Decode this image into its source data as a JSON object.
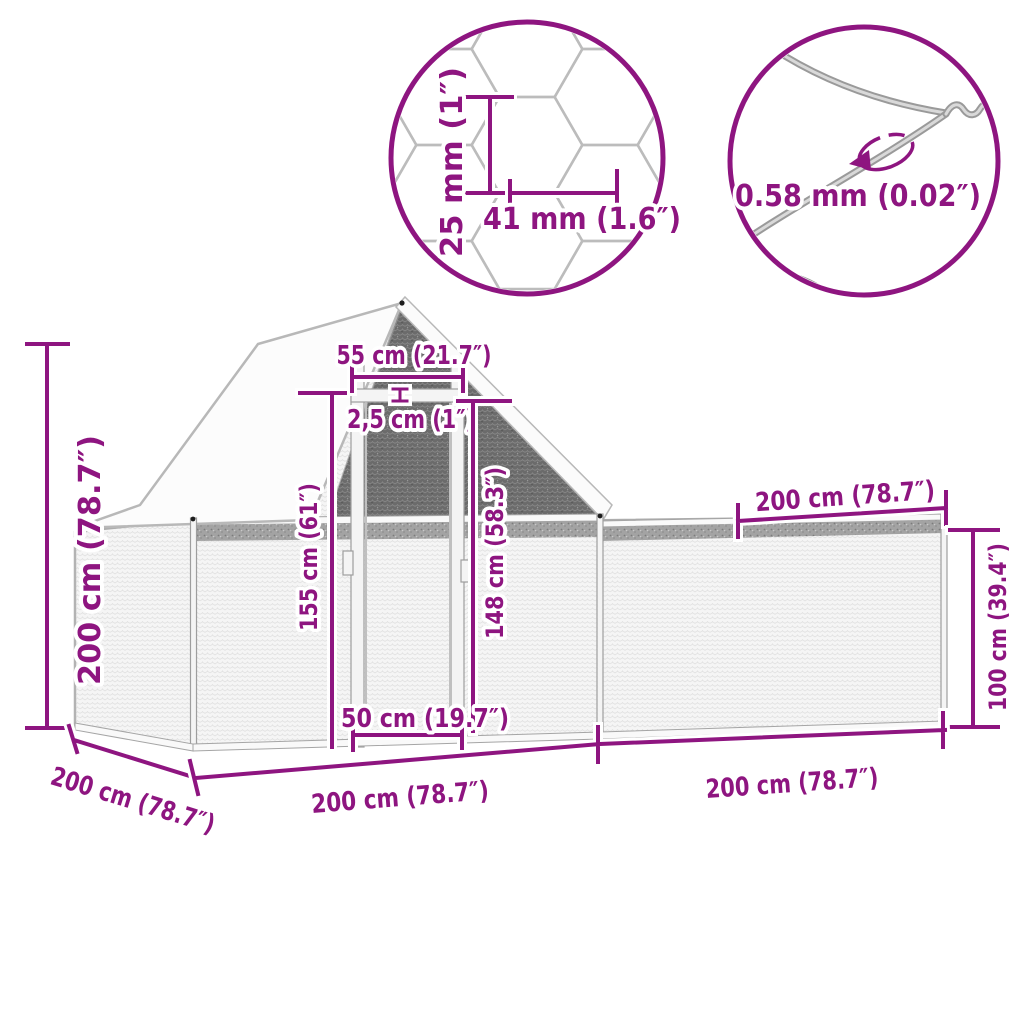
{
  "colors": {
    "accent": "#8E1580",
    "mesh_light": "#f5f5f5",
    "mesh_dark": "#6b6b6b",
    "roof_white": "#fcfcfc",
    "wire_gray": "#b3b3b3"
  },
  "mesh_detail": {
    "cell_height": "25 mm (1″)",
    "cell_width": "41 mm (1.6″)"
  },
  "wire_detail": {
    "thickness": "0.58 mm (0.02″)"
  },
  "dimensions": {
    "total_height": "200 cm (78.7″)",
    "top_panel_width": "55 cm (21.7″)",
    "frame_tube": "2,5 cm (1″)",
    "door_height": "155 cm (61″)",
    "inner_door_height": "148 cm (58.3″)",
    "run_length_top": "200 cm (78.7″)",
    "run_height": "100 cm (39.4″)",
    "door_width": "50 cm (19.7″)",
    "base_depth": "200 cm (78.7″)",
    "base_length_left": "200 cm (78.7″)",
    "base_length_right": "200 cm (78.7″)"
  }
}
